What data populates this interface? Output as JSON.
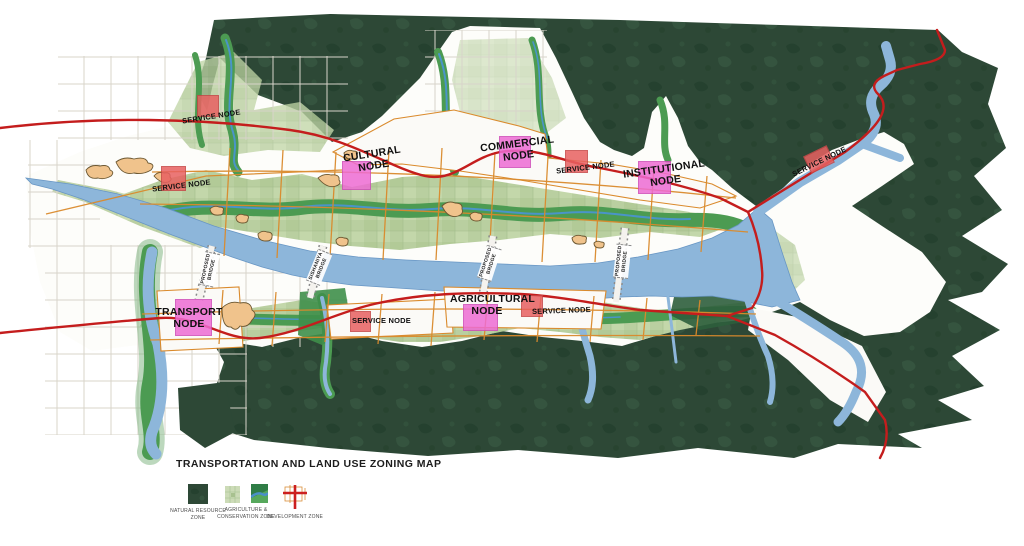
{
  "map_title": "TRANSPORTATION AND LAND USE ZONING MAP",
  "nodes": [
    {
      "id": "service-1",
      "label": "SERVICE NODE",
      "type": "service"
    },
    {
      "id": "service-2",
      "label": "SERVICE NODE",
      "type": "service"
    },
    {
      "id": "cultural",
      "label": "CULTURAL NODE",
      "type": "major"
    },
    {
      "id": "commercial",
      "label": "COMMERCIAL NODE",
      "type": "major"
    },
    {
      "id": "service-3",
      "label": "SERVICE NODE",
      "type": "service"
    },
    {
      "id": "institutional",
      "label": "INSTITUTIONAL NODE",
      "type": "major"
    },
    {
      "id": "service-4",
      "label": "SERVICE NODE",
      "type": "service"
    },
    {
      "id": "transport",
      "label": "TRANSPORT NODE",
      "type": "major"
    },
    {
      "id": "service-5",
      "label": "SERVICE NODE",
      "type": "service"
    },
    {
      "id": "agricultural",
      "label": "AGRICULTURAL NODE",
      "type": "major"
    },
    {
      "id": "service-6",
      "label": "SERVICE NODE",
      "type": "service"
    }
  ],
  "bridges": [
    {
      "label": "PROPOSED BRIDGE"
    },
    {
      "label": "SISHANIYA BRIDGE"
    },
    {
      "label": "PROPOSED BRIDGE"
    },
    {
      "label": "PROPOSED BRIDGE"
    }
  ],
  "legend": {
    "items": [
      {
        "label": "NATURAL RESOURCE ZONE"
      },
      {
        "label": "AGRICULTURE & CONSERVATION ZONE"
      },
      {
        "label": "DEVELOPMENT ZONE"
      }
    ]
  },
  "colors": {
    "natural_resource_zone": "#2d4836",
    "agriculture_zone": "#b9cfa0",
    "conservation_band": "#4c9b52",
    "water": "#8db6da",
    "stream": "#4a94c8",
    "major_road": "#c41d1d",
    "grid_road": "#da8a2c",
    "node_major": "#ee6cd4",
    "node_service": "#e86161",
    "settlement": "#f0c38c"
  }
}
